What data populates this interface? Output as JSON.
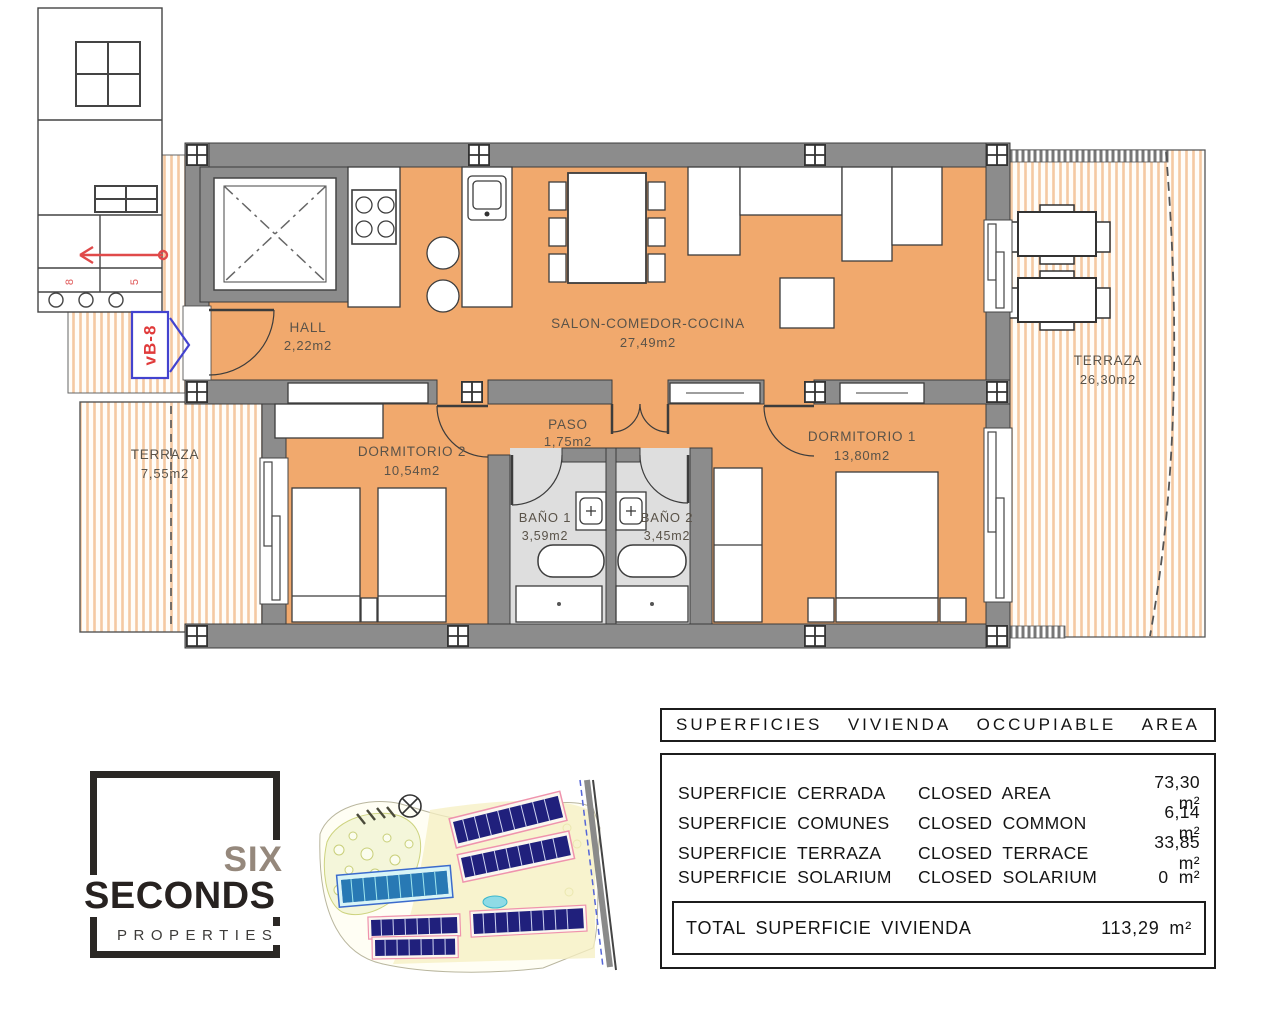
{
  "floorplan": {
    "unit_tag": "vB-8",
    "stair_marks": {
      "left": "8",
      "right": "5"
    },
    "rooms": {
      "hall": {
        "name": "HALL",
        "area": "2,22m2"
      },
      "salon": {
        "name": "SALON-COMEDOR-COCINA",
        "area": "27,49m2"
      },
      "paso": {
        "name": "PASO",
        "area": "1,75m2"
      },
      "dormitorio2": {
        "name": "DORMITORIO 2",
        "area": "10,54m2"
      },
      "dormitorio1": {
        "name": "DORMITORIO 1",
        "area": "13,80m2"
      },
      "bano1": {
        "name": "BAÑO 1",
        "area": "3,59m2"
      },
      "bano2": {
        "name": "BAÑO 2",
        "area": "3,45m2"
      },
      "terraza_main": {
        "name": "TERRAZA",
        "area": "26,30m2"
      },
      "terraza_side": {
        "name": "TERRAZA",
        "area": "7,55m2"
      }
    },
    "colors": {
      "floor": "#f1a96d",
      "wall": "#8c8c8c",
      "terrace_stripe": "#f5c9a2",
      "bath_floor": "#dedede",
      "tag_blue": "#4343cf",
      "tag_red": "#e03a3a"
    }
  },
  "logo": {
    "line1": "SIX",
    "line2": "SECONDS",
    "line3": "PROPERTIES"
  },
  "area_table": {
    "header_words": [
      "SUPERFICIES",
      "VIVIENDA",
      "OCCUPIABLE",
      "AREA"
    ],
    "rows": [
      {
        "es": "SUPERFICIE CERRADA",
        "en": "CLOSED AREA",
        "value": "73,30 m²"
      },
      {
        "es": "SUPERFICIE COMUNES",
        "en": "CLOSED COMMON",
        "value": "6,14 m²"
      },
      {
        "es": "SUPERFICIE TERRAZA",
        "en": "CLOSED TERRACE",
        "value": "33,85 m²"
      },
      {
        "es": "SUPERFICIE SOLARIUM",
        "en": "CLOSED SOLARIUM",
        "value": "0 m²"
      }
    ],
    "total_label": "TOTAL SUPERFICIE VIVIENDA",
    "total_value": "113,29 m²"
  }
}
